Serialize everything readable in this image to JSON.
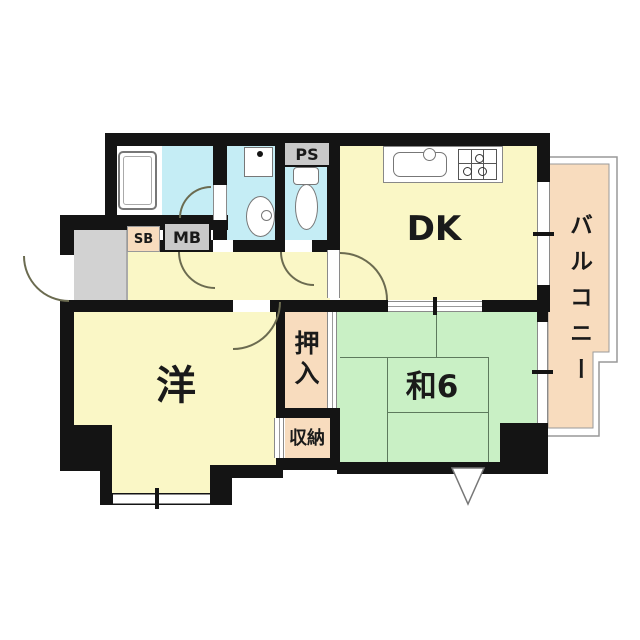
{
  "floor_plan": {
    "rooms": {
      "dk": "DK",
      "western_room": "洋",
      "japanese_room": "和6",
      "balcony": "バルコニー",
      "oshiire_closet": "押入",
      "storage": "収納",
      "shoe_box": "SB",
      "meter_box": "MB",
      "pipe_space": "PS"
    },
    "colors": {
      "wall": "#141414",
      "room_floor": "#faf7c6",
      "wet_area": "#c5edf5",
      "tatami": "#c9f0c5",
      "closet": "#f8dcbe",
      "entrance": "#d2d2d2",
      "utility_box": "#c9c9c9",
      "outline": "#8a8a8a"
    }
  }
}
